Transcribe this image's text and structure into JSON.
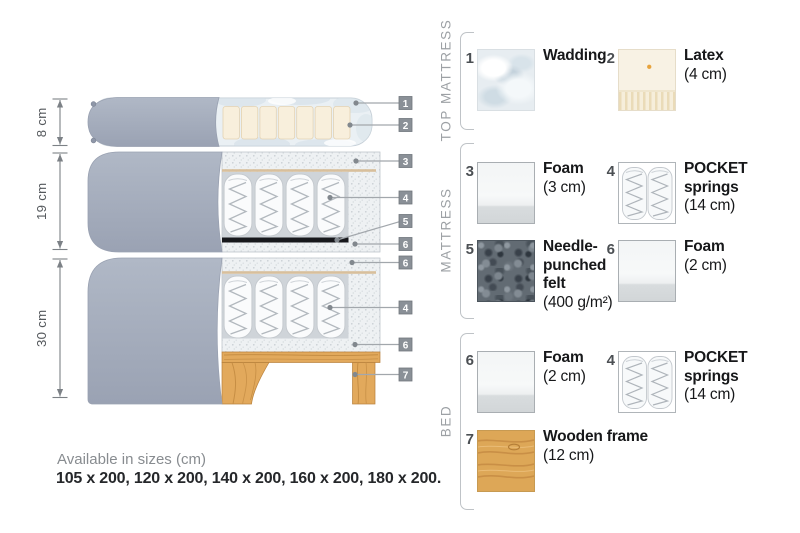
{
  "diagram": {
    "dimensions": [
      {
        "label": "8 cm"
      },
      {
        "label": "19 cm"
      },
      {
        "label": "30 cm"
      }
    ],
    "callouts": {
      "c1": "1",
      "c2": "2",
      "c3": "3",
      "c4": "4",
      "c5": "5",
      "c6": "6",
      "c7": "6",
      "c8": "4",
      "c9": "6",
      "c10": "7"
    }
  },
  "legend": {
    "sections": [
      {
        "title": "TOP MATTRESS",
        "items": [
          {
            "num": "1",
            "name": "Wadding",
            "detail": ""
          },
          {
            "num": "2",
            "name": "Latex",
            "detail": "(4 cm)"
          }
        ]
      },
      {
        "title": "MATTRESS",
        "items": [
          {
            "num": "3",
            "name": "Foam",
            "detail": "(3 cm)"
          },
          {
            "num": "4",
            "name": "POCKET springs",
            "detail": "(14 cm)"
          },
          {
            "num": "5",
            "name": "Needle-punched felt",
            "detail": "(400 g/m²)"
          },
          {
            "num": "6",
            "name": "Foam",
            "detail": "(2 cm)"
          }
        ]
      },
      {
        "title": "BED",
        "items": [
          {
            "num": "6",
            "name": "Foam",
            "detail": "(2 cm)"
          },
          {
            "num": "4",
            "name": "POCKET springs",
            "detail": "(14 cm)"
          },
          {
            "num": "7",
            "name": "Wooden frame",
            "detail": "(12 cm)"
          }
        ]
      }
    ]
  },
  "footer": {
    "line1": "Available in sizes (cm)",
    "line2": "105 x 200, 120 x 200, 140 x 200, 160 x 200, 180 x 200."
  }
}
